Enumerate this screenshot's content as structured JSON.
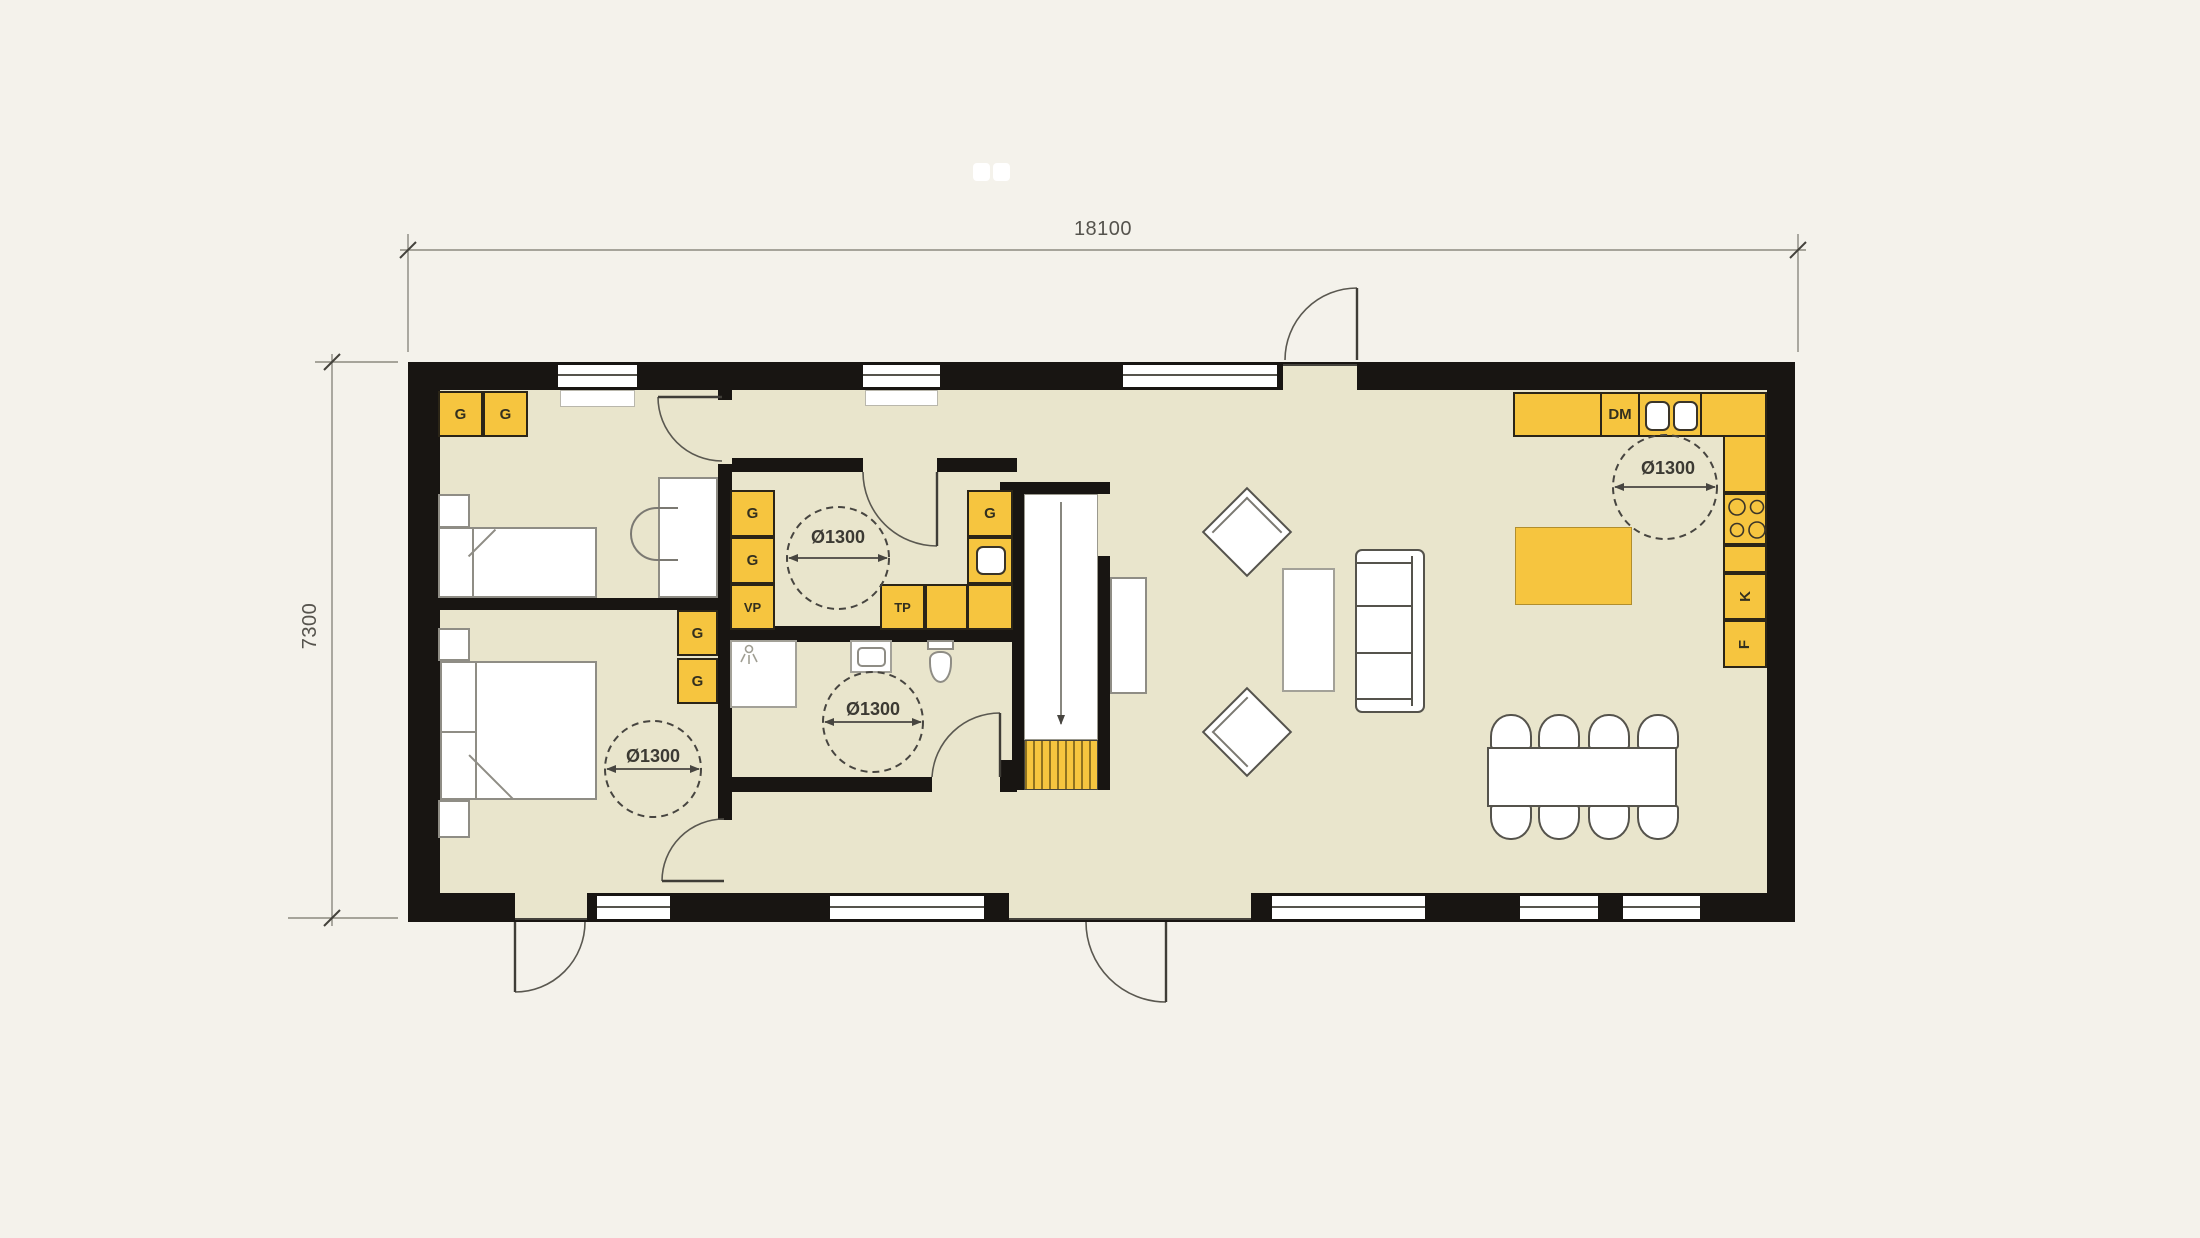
{
  "title": "Single-storey house floor plan",
  "dimensions": {
    "width_label": "18100",
    "height_label": "7300"
  },
  "labels": {
    "turning_circle": "Ø1300",
    "wardrobe": "G",
    "water_heater": "VP",
    "laundry_unit": "TP",
    "dishwasher": "DM",
    "fridge": "K",
    "freezer": "F"
  },
  "colors": {
    "background": "#f4f2eb",
    "floor": "#e9e5cc",
    "wall": "#181512",
    "fixture_yellow": "#f6c53f",
    "annotation": "#55534d"
  },
  "annotation_counts": {
    "turning_circles": 4,
    "wardrobe_units": 7
  }
}
